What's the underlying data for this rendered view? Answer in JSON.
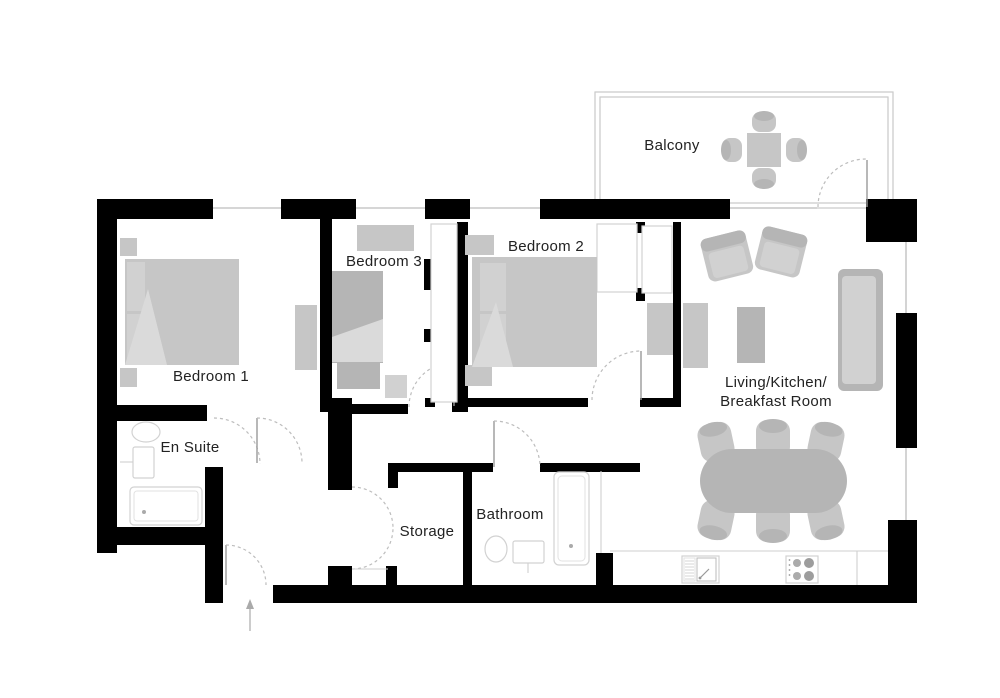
{
  "floorplan": {
    "rooms": {
      "balcony": {
        "label": "Balcony"
      },
      "bedroom1": {
        "label": "Bedroom 1"
      },
      "bedroom2": {
        "label": "Bedroom 2"
      },
      "bedroom3": {
        "label": "Bedroom 3"
      },
      "ensuite": {
        "label": "En Suite"
      },
      "storage": {
        "label": "Storage"
      },
      "bathroom": {
        "label": "Bathroom"
      },
      "living": {
        "label_line1": "Living/Kitchen/",
        "label_line2": "Breakfast Room"
      }
    },
    "colors": {
      "wall": "#000000",
      "furniture": "#c6c6c6",
      "furniture_light": "#d1d1d1",
      "furniture_dark": "#b5b5b5",
      "outline": "#c9c9c9",
      "text": "#222222"
    }
  }
}
